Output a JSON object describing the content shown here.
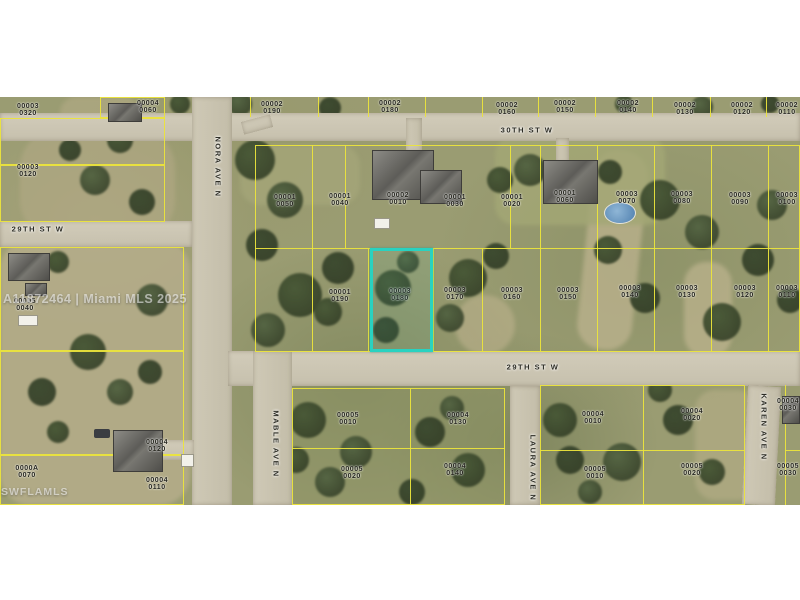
{
  "image": {
    "kind": "aerial-parcel-map",
    "width": 800,
    "height": 600
  },
  "watermarks": {
    "mls_id": "A11872464 | Miami MLS 2025",
    "swfl": "SWFLAMLS"
  },
  "colors": {
    "parcel_line": "#ebe43c",
    "highlight": "#29d2c0",
    "road": "#cdc7b4",
    "band": "#ffffff"
  },
  "highlighted_parcel": {
    "block": "00003",
    "lot": "0180"
  },
  "streets": [
    {
      "name": "30TH ST W",
      "orientation": "horizontal"
    },
    {
      "name": "29TH ST W",
      "orientation": "horizontal"
    },
    {
      "name": "29TH ST W",
      "orientation": "horizontal"
    },
    {
      "name": "NORA AVE N",
      "orientation": "vertical"
    },
    {
      "name": "MABLE AVE N",
      "orientation": "vertical"
    },
    {
      "name": "LAURA AVE N",
      "orientation": "vertical"
    },
    {
      "name": "KAREN AVE N",
      "orientation": "vertical"
    }
  ],
  "parcel_labels": [
    {
      "block": "00003",
      "lot": "0320"
    },
    {
      "block": "00004",
      "lot": "0060"
    },
    {
      "block": "00002",
      "lot": "0190"
    },
    {
      "block": "00002",
      "lot": "0180"
    },
    {
      "block": "00002",
      "lot": "0160"
    },
    {
      "block": "00002",
      "lot": "0150"
    },
    {
      "block": "00002",
      "lot": "0140"
    },
    {
      "block": "00002",
      "lot": "0130"
    },
    {
      "block": "00002",
      "lot": "0120"
    },
    {
      "block": "00002",
      "lot": "0110"
    },
    {
      "block": "00003",
      "lot": "0120"
    },
    {
      "block": "00005",
      "lot": "0040"
    },
    {
      "block": "0000A",
      "lot": "0070"
    },
    {
      "block": "00004",
      "lot": "0120"
    },
    {
      "block": "00004",
      "lot": "0110"
    },
    {
      "block": "00001",
      "lot": "0050"
    },
    {
      "block": "00001",
      "lot": "0040"
    },
    {
      "block": "00002",
      "lot": "0010"
    },
    {
      "block": "00001",
      "lot": "0030"
    },
    {
      "block": "00001",
      "lot": "0020"
    },
    {
      "block": "00001",
      "lot": "0060"
    },
    {
      "block": "00003",
      "lot": "0070"
    },
    {
      "block": "00003",
      "lot": "0080"
    },
    {
      "block": "00003",
      "lot": "0090"
    },
    {
      "block": "00003",
      "lot": "0100"
    },
    {
      "block": "00001",
      "lot": "0190"
    },
    {
      "block": "00003",
      "lot": "0180"
    },
    {
      "block": "00003",
      "lot": "0170"
    },
    {
      "block": "00003",
      "lot": "0160"
    },
    {
      "block": "00003",
      "lot": "0150"
    },
    {
      "block": "00003",
      "lot": "0140"
    },
    {
      "block": "00003",
      "lot": "0130"
    },
    {
      "block": "00003",
      "lot": "0120"
    },
    {
      "block": "00003",
      "lot": "0110"
    },
    {
      "block": "00005",
      "lot": "0010"
    },
    {
      "block": "00004",
      "lot": "0130"
    },
    {
      "block": "00005",
      "lot": "0020"
    },
    {
      "block": "00004",
      "lot": "0140"
    },
    {
      "block": "00004",
      "lot": "0010"
    },
    {
      "block": "00004",
      "lot": "0020"
    },
    {
      "block": "00005",
      "lot": "0010"
    },
    {
      "block": "00005",
      "lot": "0020"
    },
    {
      "block": "00004",
      "lot": "0030"
    },
    {
      "block": "00005",
      "lot": "0030"
    }
  ]
}
